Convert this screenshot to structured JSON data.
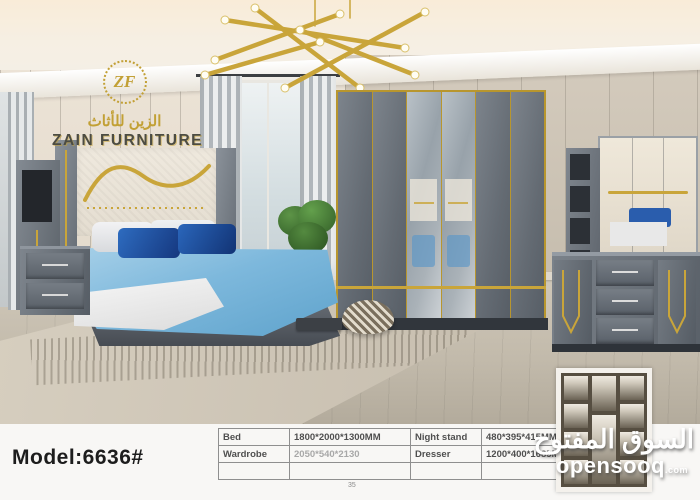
{
  "logo": {
    "monogram": "ZF",
    "arabic": "الزين للأثاث",
    "name": "ZAIN FURNITURE"
  },
  "footer": {
    "model_label": "Model:6636#",
    "page_number": "35"
  },
  "specs": {
    "rows": [
      {
        "c0": "Bed",
        "c1": "1800*2000*1300MM",
        "c2": "Night stand",
        "c3": "480*395*415MM"
      },
      {
        "c0": "Wardrobe",
        "c1": "2050*540*2130",
        "c2": "Dresser",
        "c3": "1200*400*1685MM"
      },
      {
        "c0": "",
        "c1": "",
        "c2": "",
        "c3": ""
      }
    ]
  },
  "watermark": {
    "arabic": "السوق المفتوح",
    "domain": "opensooq",
    "tld": ".com"
  },
  "colors": {
    "gold_accent": "#c9a53a",
    "furniture_gray": "#646b73",
    "dark_base": "#31363c",
    "wall_cream": "#e8dfd2",
    "wall_greige": "#c9c0b1",
    "duvet_blue": "#7db8dc",
    "pillow_navy": "#15377e",
    "logo_gold": "#c2a035",
    "watermark_white": "#ffffff"
  }
}
